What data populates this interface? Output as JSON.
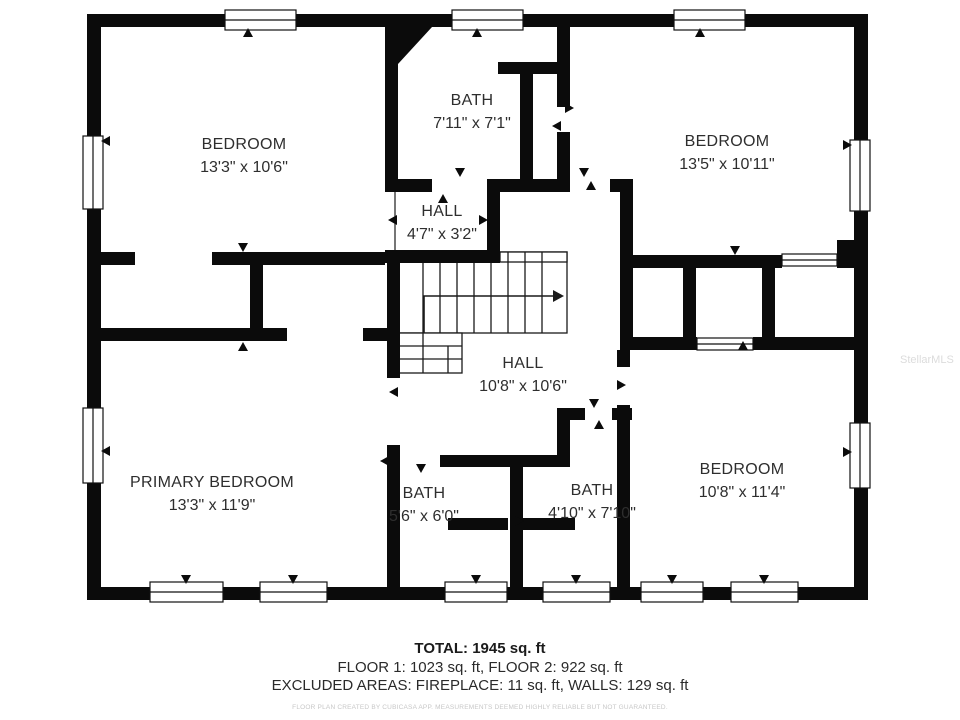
{
  "floor_plan": {
    "rooms": [
      {
        "name": "BEDROOM",
        "dims": "13'3\" x 10'6\""
      },
      {
        "name": "BATH",
        "dims": "7'11\" x 7'1\""
      },
      {
        "name": "BEDROOM",
        "dims": "13'5\" x 10'11\""
      },
      {
        "name": "HALL",
        "dims": "4'7\" x 3'2\""
      },
      {
        "name": "HALL",
        "dims": "10'8\" x 10'6\""
      },
      {
        "name": "PRIMARY BEDROOM",
        "dims": "13'3\" x 11'9\""
      },
      {
        "name": "BATH",
        "dims": "5'6\" x 6'0\""
      },
      {
        "name": "BATH",
        "dims": "4'10\" x 7'10\""
      },
      {
        "name": "BEDROOM",
        "dims": "10'8\" x 11'4\""
      }
    ]
  },
  "summary": {
    "total": "TOTAL: 1945 sq. ft",
    "floors": "FLOOR 1: 1023 sq. ft, FLOOR 2: 922 sq. ft",
    "excluded": "EXCLUDED AREAS: FIREPLACE: 11 sq. ft, WALLS: 129 sq. ft",
    "disclaimer": "FLOOR PLAN CREATED BY CUBICASA APP. MEASUREMENTS DEEMED HIGHLY RELIABLE BUT NOT GUARANTEED."
  },
  "watermark": "StellarMLS",
  "colors": {
    "wall": "#0b0b0b",
    "stair_line": "#1a1a1a",
    "text": "#2e2e2e",
    "disclaimer_text": "#c7c7c7",
    "watermark_text": "#dcdcdc",
    "background": "#ffffff"
  }
}
